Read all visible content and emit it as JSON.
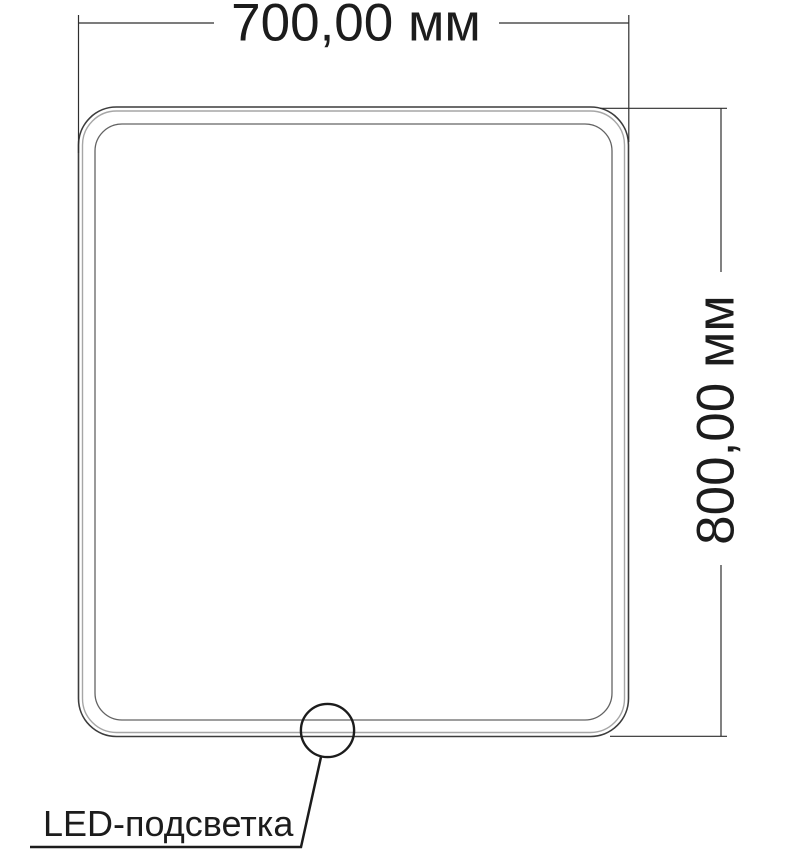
{
  "drawing": {
    "width_dimension": {
      "label": "700,00 мм",
      "value_mm": 700
    },
    "height_dimension": {
      "label": "800,00 мм",
      "value_mm": 800
    },
    "callout": {
      "label": "LED-подсветка"
    }
  },
  "colors": {
    "background": "#ffffff",
    "dimension_line": "#2e2e2e",
    "frame_outer": "#3c3c3c",
    "frame_middle": "#a6a6a6",
    "frame_inner": "#636363",
    "callout_line": "#1c1c1c",
    "text": "#1c1c1c"
  }
}
